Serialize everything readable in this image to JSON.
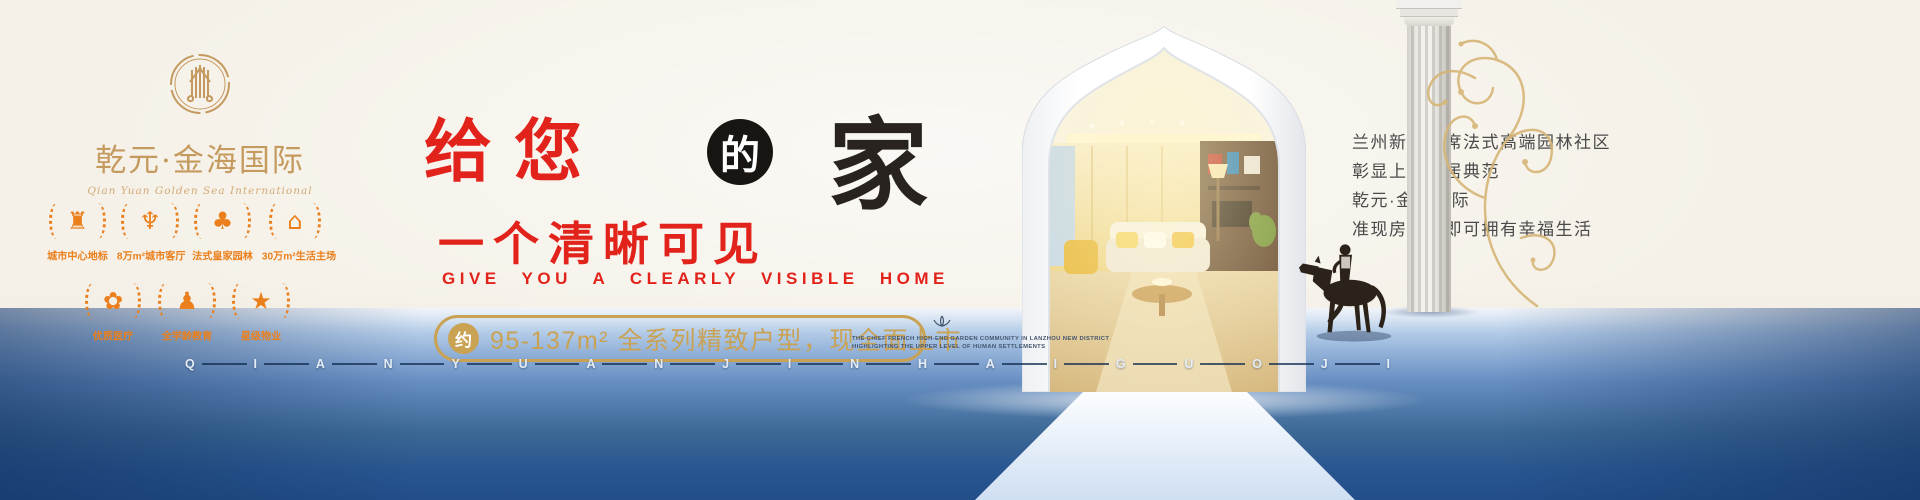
{
  "brand": {
    "logo_title": "乾元·金海国际",
    "logo_subtitle": "Qian Yuan Golden Sea International",
    "logo_icon": "column-crest-icon"
  },
  "badges": {
    "row1": [
      {
        "icon": "city-landmark-icon",
        "glyph": "♜",
        "label": "城市中心地标"
      },
      {
        "icon": "wings-icon",
        "glyph": "♆",
        "label": "8万m²城市客厅"
      },
      {
        "icon": "garden-tree-icon",
        "glyph": "♣",
        "label": "法式皇家园林"
      },
      {
        "icon": "house-icon",
        "glyph": "⌂",
        "label": "30万m²生活主场"
      }
    ],
    "row2": [
      {
        "icon": "flower-medical-icon",
        "glyph": "✿",
        "label": "优质医疗"
      },
      {
        "icon": "people-education-icon",
        "glyph": "♟",
        "label": "全学龄教育"
      },
      {
        "icon": "five-star-icon",
        "glyph": "★",
        "label": "星级物业"
      }
    ]
  },
  "headline": {
    "give_you": "给您",
    "de": "的",
    "home": "家",
    "line2": "一个清晰可见",
    "english": "GIVE YOU A CLEARLY VISIBLE HOME"
  },
  "offer": {
    "approx_badge": "约",
    "text": "95-137m² 全系列精致户型，现全面上市"
  },
  "right_text": {
    "line1": "兰州新区首席法式高端园林社区",
    "line2": "彰显上层人居典范",
    "line3": "乾元·金海国际",
    "line4": "准现房让您即可拥有幸福生活"
  },
  "fine_print": {
    "line1": "THE CHIEF FRENCH HIGH-END GARDEN COMMUNITY IN LANZHOU NEW DISTRICT",
    "line2": "HIGHLIGHTING THE UPPER LEVEL OF HUMAN SETTLEMENTS"
  },
  "bottom_letters": [
    "Q",
    "I",
    "A",
    "N",
    "Y",
    "U",
    "A",
    "N",
    "J",
    "I",
    "N",
    "H",
    "A",
    "I",
    "G",
    "U",
    "O",
    "J",
    "I"
  ],
  "colors": {
    "gold": "#c9a254",
    "logo_gold": "#c59a5f",
    "badge_orange": "#ea7f1c",
    "headline_red": "#e2231c",
    "ink_black": "#28231f",
    "floor_blue": "#30619f",
    "background_cream": "#f5f1e8"
  }
}
